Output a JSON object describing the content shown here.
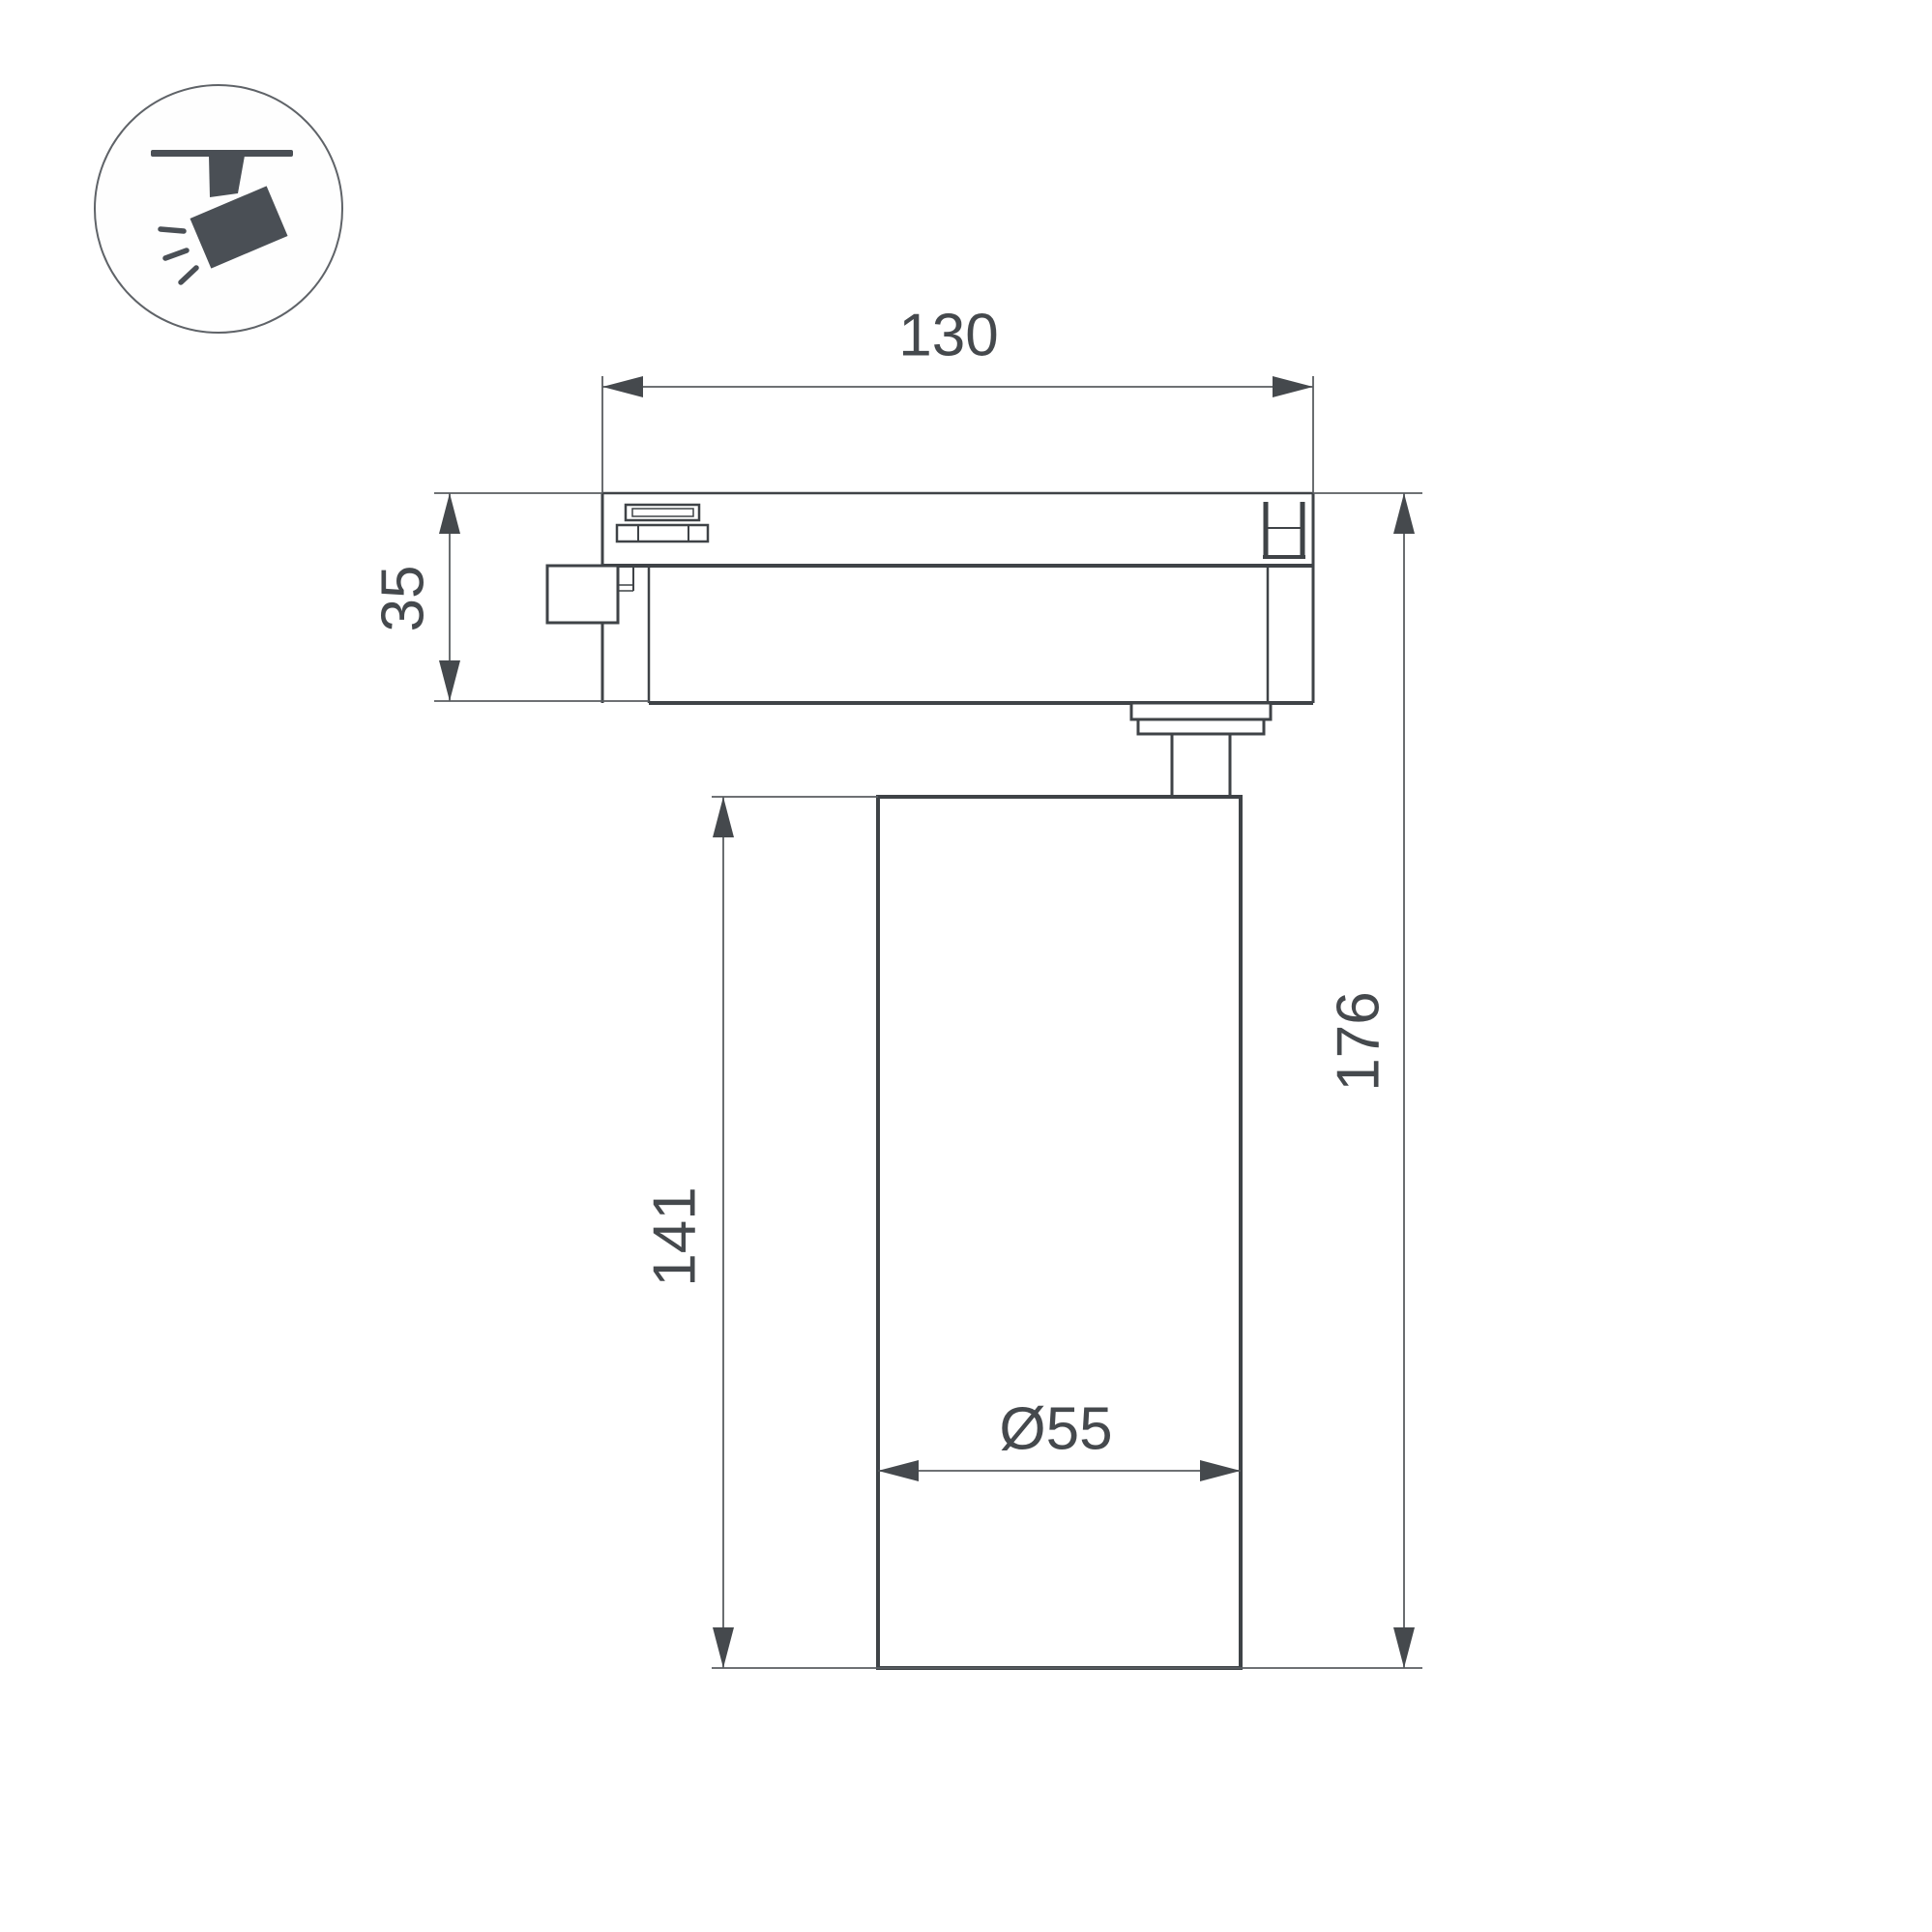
{
  "title": "Track spotlight dimensional drawing",
  "background": "#ffffff",
  "colors": {
    "outline": "#3f4347",
    "dimension_line": "#595d61",
    "text": "#45494d",
    "icon_fill": "#4a4f55",
    "icon_circle_stroke": "#5f6368"
  },
  "icon": {
    "name": "track-spotlight-icon"
  },
  "dims": {
    "track_width": {
      "label": "130"
    },
    "adapter_height": {
      "label": "35"
    },
    "body_height": {
      "label": "141"
    },
    "total_height": {
      "label": "176"
    },
    "body_diameter": {
      "label": "Ø55"
    }
  }
}
